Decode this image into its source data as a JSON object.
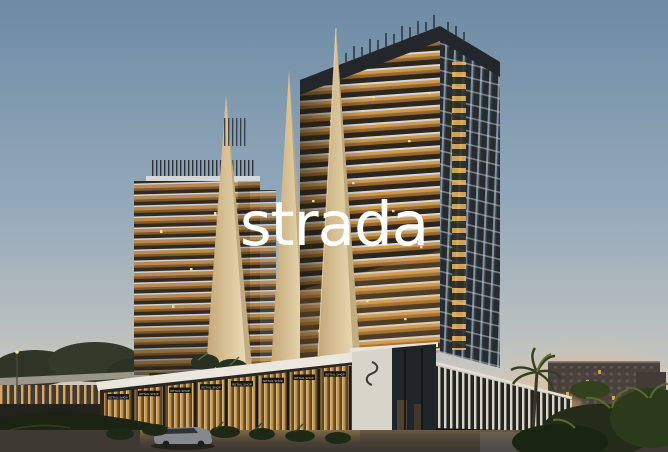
{
  "watermark": {
    "text": "strada"
  },
  "scene": {
    "description": "Twilight architectural rendering of the Strada residential towers: two amber-lit balcony towers with cream sail-shaped fins above a glowing retail podium, palm landscaping, background apartment blocks and a wet foreground road with a car",
    "palette": {
      "sky_top": "#6e8ba5",
      "sky_mid": "#93a9ba",
      "sky_lower": "#bcc1bf",
      "sky_horizon": "#d7cec1",
      "sky_warm": "#cfc0ae",
      "fin_cream_light": "#efe1bd",
      "fin_cream_dark": "#c4a878",
      "balcony_amber": "#d09a4e",
      "balcony_shadow": "#2e251b",
      "slab_light": "#d4d8db",
      "tower_crown": "#23272b",
      "podium_fascia": "#eae7df",
      "storefront_glow": "#ecc17a",
      "entrance_stone": "#d9d4c9",
      "foliage_dark": "#222c18",
      "road": "#3e3933"
    }
  },
  "podium": {
    "retail_signs": [
      {
        "label": "RETAIL SHOP"
      },
      {
        "label": "RETAIL SHOP"
      },
      {
        "label": "RETAIL SHOP"
      },
      {
        "label": "RETAIL SHOP"
      },
      {
        "label": "RETAIL SHOP"
      },
      {
        "label": "RETAIL SHOP"
      },
      {
        "label": "RETAIL SHOP"
      },
      {
        "label": "RETAIL SHOP"
      }
    ]
  }
}
